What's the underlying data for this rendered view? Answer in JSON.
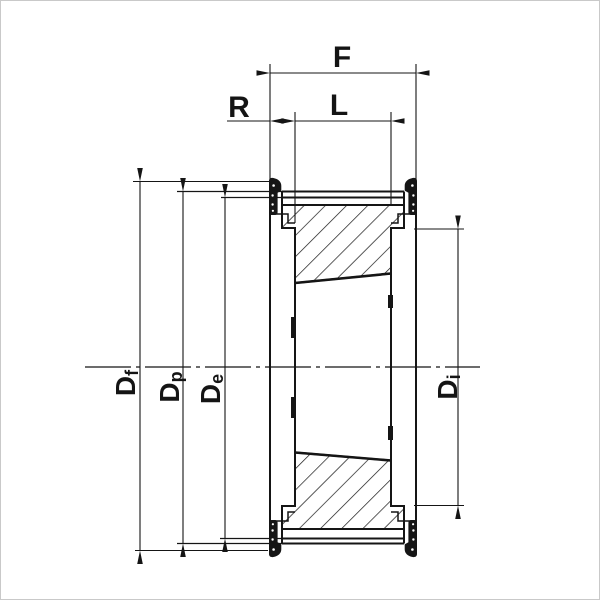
{
  "title": "Taper-bore timing belt pulley cross-section drawing",
  "colors": {
    "line": "#151515",
    "background": "#ffffff"
  },
  "labels": {
    "width_overall": {
      "text": "F"
    },
    "width_hub": {
      "text": "L"
    },
    "flange_offset": {
      "text": "R"
    },
    "flange_diameter": {
      "main": "D",
      "sub": "f"
    },
    "pitch_diameter": {
      "main": "D",
      "sub": "p"
    },
    "outside_diameter": {
      "main": "D",
      "sub": "e"
    },
    "hub_diameter": {
      "main": "D",
      "sub": "i"
    }
  }
}
